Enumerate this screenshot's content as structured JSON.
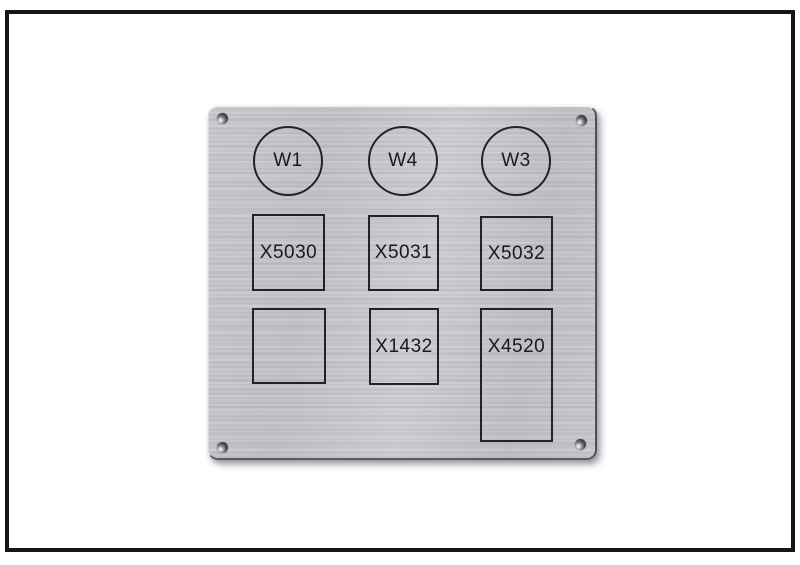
{
  "image": {
    "description": "Photo of a brushed aluminum panel label plate with engraved outlines and designators",
    "colors": {
      "background": "#ffffff",
      "frame_border": "#161616",
      "plate_metal": "#c6c6cc",
      "engraving": "#19191e"
    }
  },
  "panel": {
    "circles": [
      {
        "label": "W1"
      },
      {
        "label": "W4"
      },
      {
        "label": "W3"
      }
    ],
    "slots_row2": [
      {
        "label": "X5030"
      },
      {
        "label": "X5031"
      },
      {
        "label": "X5032"
      }
    ],
    "slots_row3": [
      {
        "label": ""
      },
      {
        "label": "X1432"
      },
      {
        "label": "X4520"
      }
    ]
  }
}
